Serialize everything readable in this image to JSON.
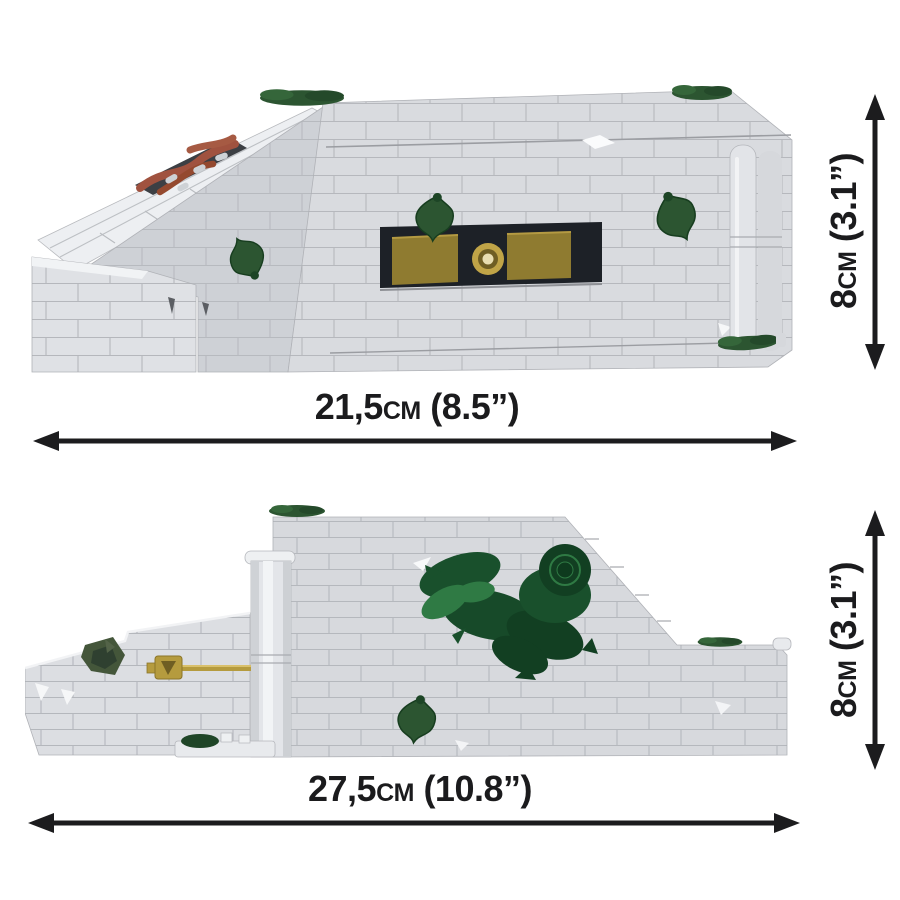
{
  "page": {
    "background": "#ffffff"
  },
  "views": {
    "front": {
      "name": "front-view",
      "width_label": "21,5cm (8.5”)",
      "height_label": "8cm (3.1”)"
    },
    "side": {
      "name": "side-view",
      "width_label": "27,5cm (10.8”)",
      "height_label": "8cm (3.1”)"
    }
  },
  "colors": {
    "background": "#ffffff",
    "dimension_line": "#1c1c1e",
    "brick_light": "#dcdee2",
    "brick_lighter": "#edeff2",
    "brick_mid": "#ced1d6",
    "brick_seam": "#aaadb2",
    "foliage_dark": "#123f22",
    "foliage_mid": "#19502c",
    "foliage_light": "#2f7a44",
    "ivy_green": "#2c5531",
    "gold": "#8f7b30",
    "gold_light": "#c0a447",
    "embrasure_dark": "#1d2127",
    "root_brown": "#9f5140"
  }
}
